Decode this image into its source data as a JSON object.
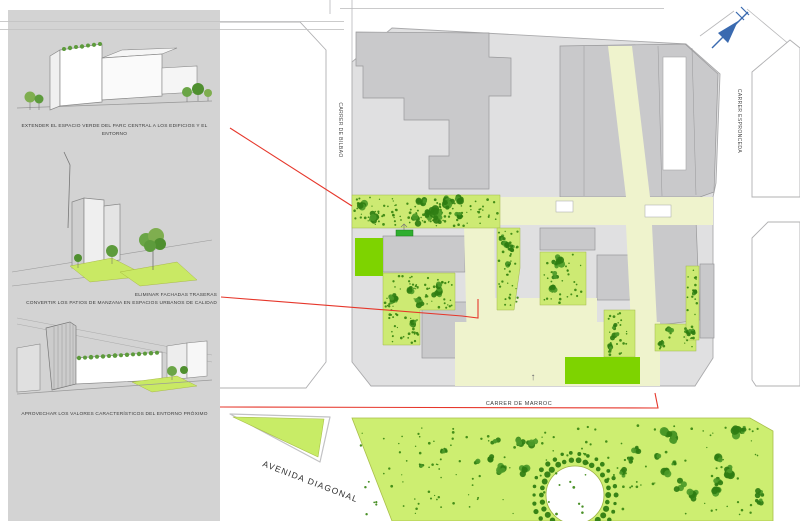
{
  "panel": {
    "annotations": [
      {
        "lines": [
          "EXTENDER EL ESPACIO VERDE DEL PARC CENTRAL A LOS EDIFICIOS Y EL ENTORNO"
        ]
      },
      {
        "lines": [
          "ELIMINAR FACHADAS TRASERAS",
          "CONVERTIR LOS PATIOS DE MANZANA EN ESPACIOS URBANOS DE CALIDAD"
        ]
      },
      {
        "lines": [
          "APROVECHAR LOS VALORES CARACTERÍSTICOS DEL ENTORNO PRÓXIMO"
        ]
      }
    ]
  },
  "map": {
    "street_labels": {
      "bilbao": "CARRER DE BILBAO",
      "espronceda": "CARRER ESPRONCEDA",
      "marroc": "CARRER DE MARROC",
      "diagonal": "AVENIDA DIAGONAL"
    },
    "building_arrow": "↑",
    "north_arrow_icon": "arrow-pointing-northeast"
  },
  "colors": {
    "panel_gray": "#d3d3d3",
    "block_gray": "#e0e0e1",
    "building_gray": "#c9c9cb",
    "path_cream": "#eff3cd",
    "green_area": "#cdea73",
    "bright_green": "#7ed300",
    "tree_green": "#2f7d12",
    "leader_red": "#e6372b",
    "north_blue": "#3a6ab0",
    "outline_gray": "#b0b0b2"
  }
}
